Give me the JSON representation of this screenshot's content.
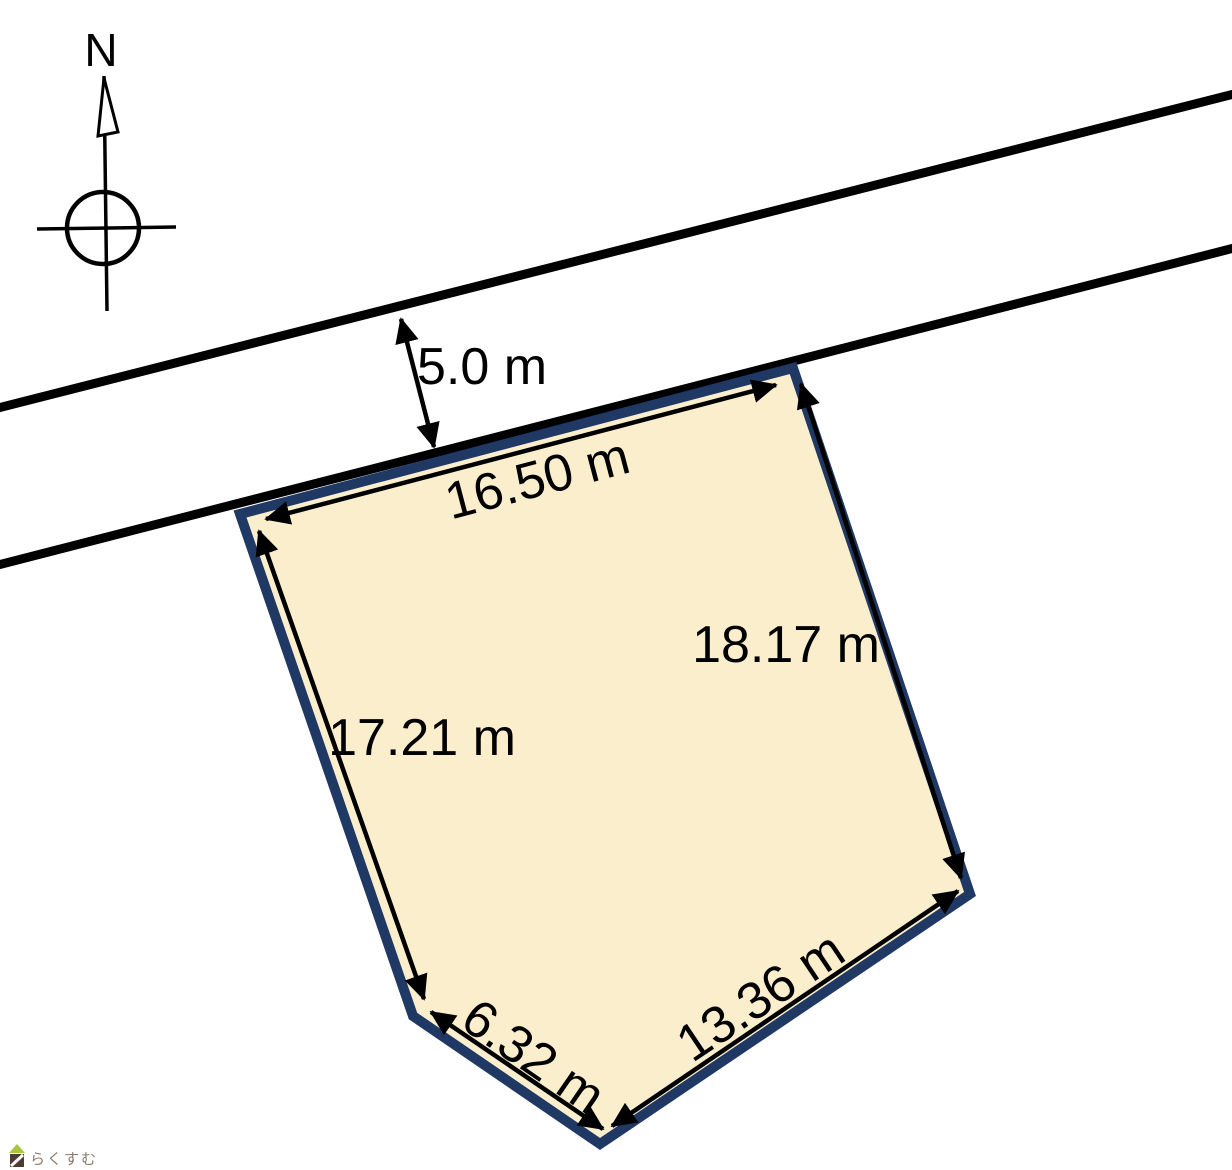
{
  "page": {
    "background_color": "#ffffff",
    "description_labels": {
      "compass_north": "N",
      "road_width": "5.0 m"
    }
  },
  "compass": {
    "label": "N",
    "color": "#000000"
  },
  "road": {
    "width_label": "5.0 m",
    "line_color": "#000000"
  },
  "parcel": {
    "fill_color": "#fbeecd",
    "stroke_color": "#1f3864",
    "dimension_color": "#000000",
    "dimensions": {
      "frontage": "16.50 m",
      "right": "18.17 m",
      "left": "17.21 m",
      "bottom_left": "6.32 m",
      "bottom_right": "13.36 m"
    }
  },
  "watermark": {
    "text": "らくすむ",
    "text_color": "#8a7b6e",
    "roof_color": "#a9c53d",
    "house_color": "#4e3c32"
  }
}
